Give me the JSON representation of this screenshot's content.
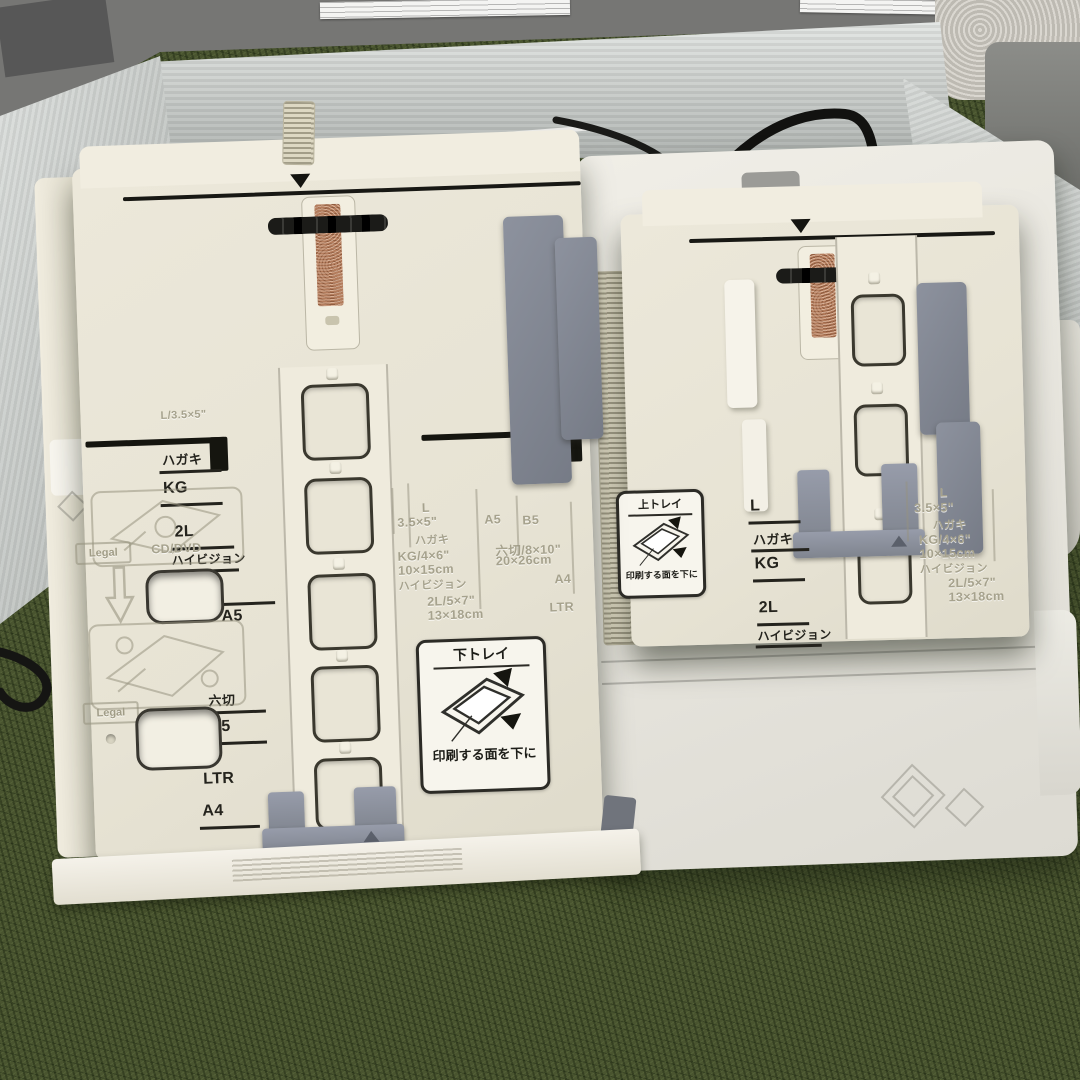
{
  "scene": {
    "description": "Photograph: two cream printer paper cassette trays (lower and upper) lying on artificial green grass inside an opened white corrugated box, printer body behind, black cables, towel and gray floor at top",
    "colors": {
      "grass": "#49542f",
      "tray_plastic": "#eae6d8",
      "box_wall": "#cdd1ce",
      "guide_gray": "#868b96",
      "copper_pad": "#b37c5c",
      "label_ink": "#24231d",
      "embossed": "#a6a28d"
    },
    "icons": {
      "alignment_marker": "triangle-down",
      "load_arrow": "arrow-up-outline",
      "paper_diagram": "tray-with-sheet-and-arrows"
    }
  },
  "lower_tray": {
    "sticker": {
      "title": "下トレイ",
      "caption": "印刷する面を下に"
    },
    "printed_labels": {
      "l35": "L/3.5×5\"",
      "hagaki": "ハガキ",
      "kg": "KG",
      "l2": "2L",
      "hivision": "ハイビジョン",
      "a5": "A5",
      "mutsugiri": "六切",
      "b5": "B5",
      "ltr": "LTR",
      "a4": "A4"
    },
    "embossed_badges": {
      "legal1": "Legal",
      "cddvd": "CD/DVD",
      "legal2": "Legal"
    },
    "embossed_sizes": {
      "l": "L",
      "s35": "3.5×5\"",
      "hagaki": "ハガキ",
      "kg46": "KG/4×6\"",
      "cm1015": "10×15cm",
      "hivision": "ハイビジョン",
      "l257": "2L/5×7\"",
      "cm1318": "13×18cm",
      "a5": "A5",
      "b5": "B5",
      "mutsu810": "六切/8×10\"",
      "cm2026": "20×26cm",
      "a4": "A4",
      "ltr": "LTR"
    }
  },
  "upper_tray": {
    "sticker": {
      "title": "上トレイ",
      "caption": "印刷する面を下に"
    },
    "printed_labels": {
      "l": "L",
      "hagaki": "ハガキ",
      "kg": "KG",
      "l2": "2L",
      "hivision": "ハイビジョン"
    },
    "embossed_sizes": {
      "l": "L",
      "s35": "3.5×5\"",
      "hagaki": "ハガキ",
      "kg46": "KG/4×6\"",
      "cm1015": "10×15cm",
      "hivision": "ハイビジョン",
      "l257": "2L/5×7\"",
      "cm1318": "13×18cm"
    }
  }
}
